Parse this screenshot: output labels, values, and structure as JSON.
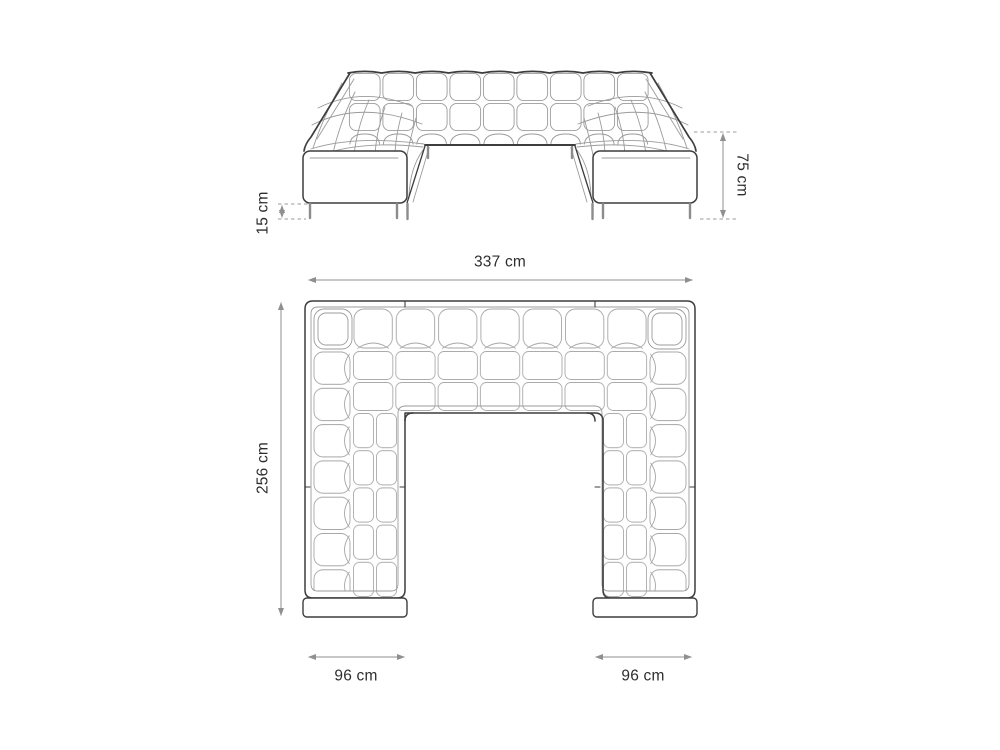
{
  "diagram": {
    "type": "furniture-dimension-drawing",
    "subject": "u-shaped-sectional-sofa",
    "front_view": {
      "leg_height_label": "15 cm",
      "total_height_label": "75 cm"
    },
    "top_view": {
      "total_width_label": "337 cm",
      "total_depth_label": "256 cm",
      "left_arm_width_label": "96 cm",
      "right_arm_width_label": "96 cm"
    },
    "colors": {
      "background": "#ffffff",
      "outline": "#3d3d3d",
      "detail_line": "#9b9b9b",
      "dimension_line": "#8f8f8f",
      "label_text": "#2e2e2e"
    }
  }
}
